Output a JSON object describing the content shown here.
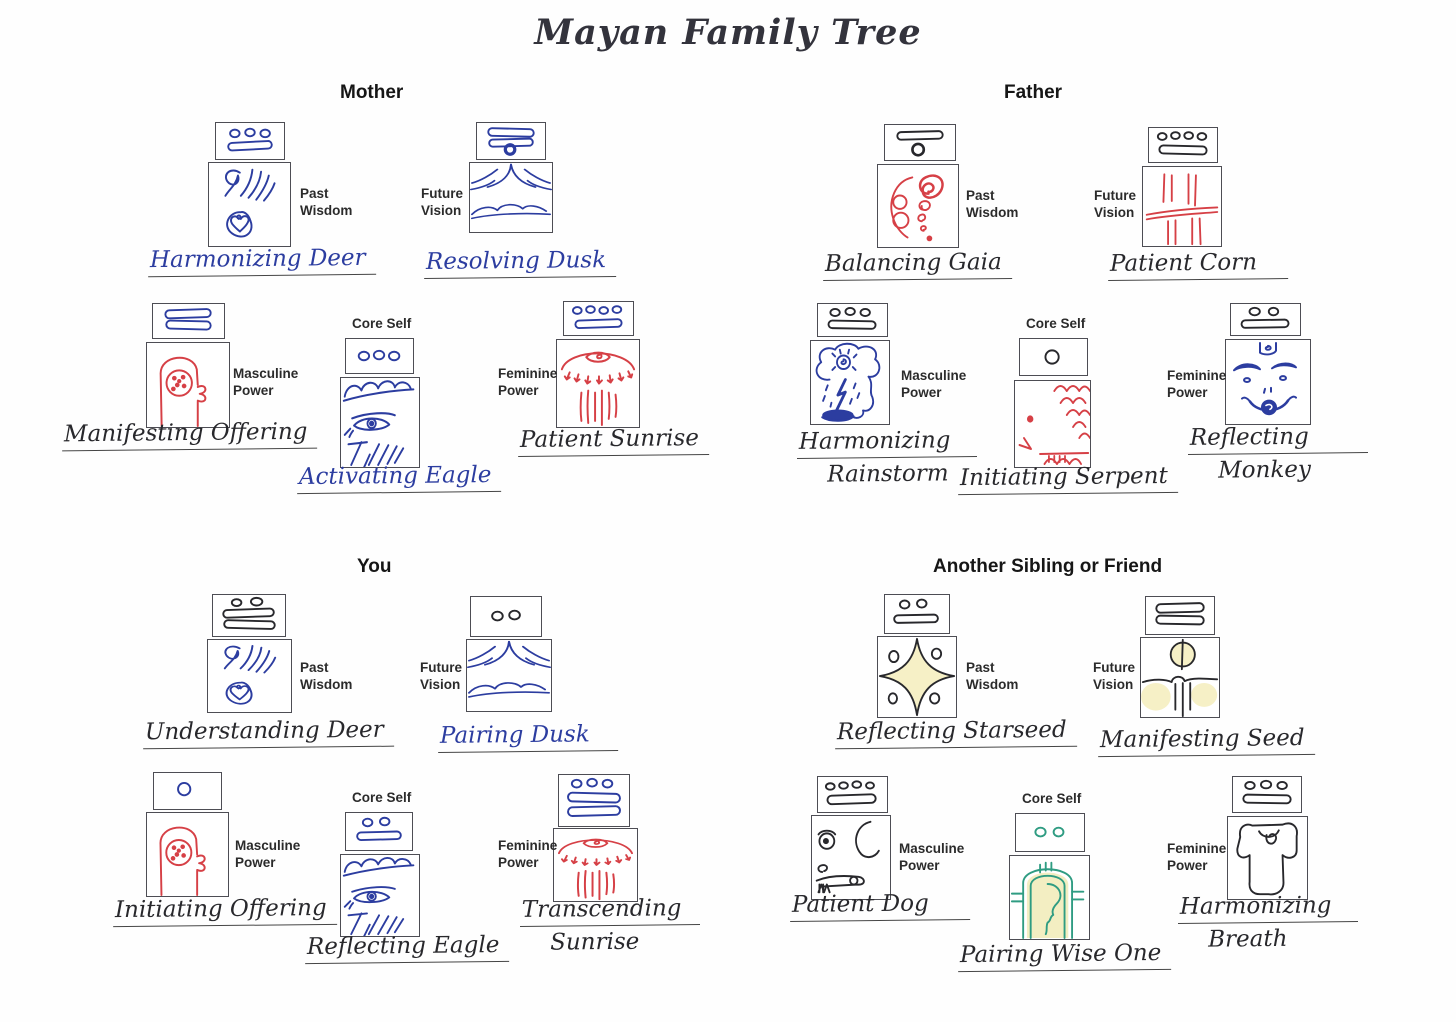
{
  "title": "Mayan Family Tree",
  "ink_colors": {
    "blue": "#2c3da0",
    "black": "#28282c",
    "red": "#d64046",
    "teal": "#2f9c82",
    "yellow_highlight": "#f6f0c6"
  },
  "sections": [
    {
      "header": "Mother",
      "cards": [
        {
          "role": "Past Wisdom",
          "lines": [
            "Harmonizing Deer"
          ],
          "glyph": {
            "dots": 3,
            "bars": 1
          },
          "drawing": "deer",
          "inks": {
            "glyph": "blue",
            "drawing": "blue",
            "name": "blue"
          }
        },
        {
          "role": "Future Vision",
          "lines": [
            "Resolving Dusk"
          ],
          "glyph": {
            "dots": 1,
            "bars": 2
          },
          "drawing": "dusk",
          "inks": {
            "glyph": "blue",
            "drawing": "blue",
            "name": "blue"
          }
        },
        {
          "role": "Masculine Power",
          "lines": [
            "Manifesting Offering"
          ],
          "glyph": {
            "dots": 0,
            "bars": 2
          },
          "drawing": "offering",
          "inks": {
            "glyph": "blue",
            "drawing": "red",
            "name": "black"
          }
        },
        {
          "role": "Core Self",
          "lines": [
            "Activating Eagle"
          ],
          "glyph": {
            "dots": 3,
            "bars": 0
          },
          "drawing": "eagle",
          "inks": {
            "glyph": "blue",
            "drawing": "blue",
            "name": "blue"
          }
        },
        {
          "role": "Feminine Power",
          "lines": [
            "Patient Sunrise"
          ],
          "glyph": {
            "dots": 4,
            "bars": 1
          },
          "drawing": "sunrise",
          "inks": {
            "glyph": "blue",
            "drawing": "red",
            "name": "black"
          }
        }
      ]
    },
    {
      "header": "Father",
      "cards": [
        {
          "role": "Past Wisdom",
          "lines": [
            "Balancing Gaia"
          ],
          "glyph": {
            "dots": 1,
            "bars": 1
          },
          "drawing": "gaia-spirals",
          "inks": {
            "glyph": "black",
            "drawing": "red",
            "name": "black"
          }
        },
        {
          "role": "Future Vision",
          "lines": [
            "Patient Corn"
          ],
          "glyph": {
            "dots": 4,
            "bars": 1
          },
          "drawing": "corn",
          "inks": {
            "glyph": "black",
            "drawing": "red",
            "name": "black"
          }
        },
        {
          "role": "Masculine Power",
          "lines": [
            "Harmonizing",
            "Rainstorm"
          ],
          "glyph": {
            "dots": 3,
            "bars": 1
          },
          "drawing": "rainstorm",
          "inks": {
            "glyph": "black",
            "drawing": "blue",
            "name": "black"
          }
        },
        {
          "role": "Core Self",
          "lines": [
            "Initiating Serpent"
          ],
          "glyph": {
            "dots": 1,
            "bars": 0
          },
          "drawing": "serpent",
          "inks": {
            "glyph": "black",
            "drawing": "red",
            "name": "black"
          }
        },
        {
          "role": "Feminine Power",
          "lines": [
            "Reflecting",
            "Monkey"
          ],
          "glyph": {
            "dots": 2,
            "bars": 1
          },
          "drawing": "monkey",
          "inks": {
            "glyph": "black",
            "drawing": "blue",
            "name": "black"
          }
        }
      ]
    },
    {
      "header": "You",
      "cards": [
        {
          "role": "Past Wisdom",
          "lines": [
            "Understanding Deer"
          ],
          "glyph": {
            "dots": 2,
            "bars": 2
          },
          "drawing": "deer",
          "inks": {
            "glyph": "black",
            "drawing": "blue",
            "name": "black"
          }
        },
        {
          "role": "Future Vision",
          "lines": [
            "Pairing Dusk"
          ],
          "glyph": {
            "dots": 2,
            "bars": 0
          },
          "drawing": "dusk",
          "inks": {
            "glyph": "black",
            "drawing": "blue",
            "name": "blue"
          }
        },
        {
          "role": "Masculine Power",
          "lines": [
            "Initiating Offering"
          ],
          "glyph": {
            "dots": 1,
            "bars": 0
          },
          "drawing": "offering",
          "inks": {
            "glyph": "blue",
            "drawing": "red",
            "name": "black"
          }
        },
        {
          "role": "Core Self",
          "lines": [
            "Reflecting Eagle"
          ],
          "glyph": {
            "dots": 2,
            "bars": 1
          },
          "drawing": "eagle",
          "inks": {
            "glyph": "blue",
            "drawing": "blue",
            "name": "black"
          }
        },
        {
          "role": "Feminine Power",
          "lines": [
            "Transcending",
            "Sunrise"
          ],
          "glyph": {
            "dots": 3,
            "bars": 2
          },
          "drawing": "sunrise",
          "inks": {
            "glyph": "blue",
            "drawing": "red",
            "name": "black"
          }
        }
      ]
    },
    {
      "header": "Another Sibling or Friend",
      "cards": [
        {
          "role": "Past Wisdom",
          "lines": [
            "Reflecting Starseed"
          ],
          "glyph": {
            "dots": 2,
            "bars": 1
          },
          "drawing": "starseed",
          "inks": {
            "glyph": "black",
            "drawing": "black",
            "name": "black"
          }
        },
        {
          "role": "Future Vision",
          "lines": [
            "Manifesting Seed"
          ],
          "glyph": {
            "dots": 0,
            "bars": 2
          },
          "drawing": "seed",
          "inks": {
            "glyph": "black",
            "drawing": "black",
            "name": "black"
          }
        },
        {
          "role": "Masculine Power",
          "lines": [
            "Patient Dog"
          ],
          "glyph": {
            "dots": 4,
            "bars": 1
          },
          "drawing": "dog",
          "inks": {
            "glyph": "black",
            "drawing": "black",
            "name": "black"
          }
        },
        {
          "role": "Core Self",
          "lines": [
            "Pairing Wise One"
          ],
          "glyph": {
            "dots": 2,
            "bars": 0
          },
          "drawing": "wise-one",
          "inks": {
            "glyph": "teal",
            "drawing": "teal",
            "name": "black"
          }
        },
        {
          "role": "Feminine Power",
          "lines": [
            "Harmonizing",
            "Breath"
          ],
          "glyph": {
            "dots": 3,
            "bars": 1
          },
          "drawing": "breath",
          "inks": {
            "glyph": "black",
            "drawing": "black",
            "name": "black"
          }
        }
      ]
    }
  ]
}
